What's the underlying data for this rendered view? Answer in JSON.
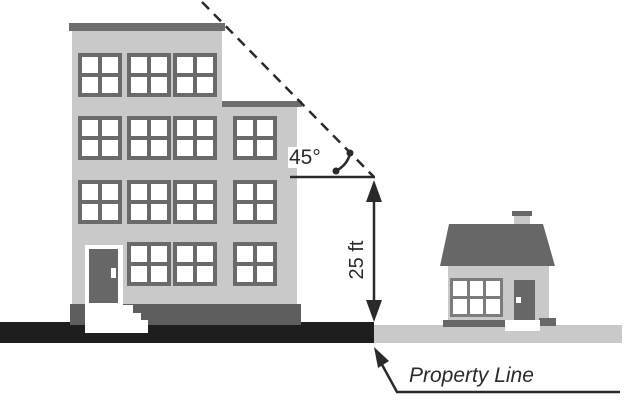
{
  "diagram": {
    "labels": {
      "angle": "45°",
      "height": "25 ft",
      "property_line": "Property Line"
    },
    "colors": {
      "ink": "#2a2a2a",
      "building_gray": "#c9c9c9",
      "dark_gray": "#676767",
      "window_frame": "#6a6a6a",
      "ground_black": "#1e1e1e",
      "ground_gray": "#c9c9c9",
      "white": "#ffffff"
    },
    "icons": {
      "angle_arc": "arc-with-end-dots",
      "height_dimension": "vertical-double-arrow",
      "property_line_pointer": "up-left-arrow-leader",
      "setback_line": "45-degree-dashed-line"
    }
  }
}
